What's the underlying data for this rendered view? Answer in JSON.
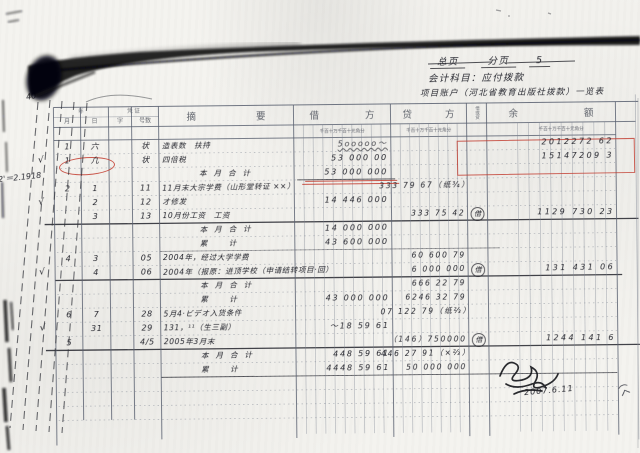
{
  "page_header": {
    "field1": "总页",
    "field2": "分页",
    "page_no": "5"
  },
  "titles": {
    "account_line": "会计科目：应付拨款",
    "project_line": "项目账户（河北省教育出版社拨款）一览表"
  },
  "side_notes": {
    "note1": "2'＝2.1918",
    "note2": "40"
  },
  "form_header": {
    "year": "年",
    "voucher": "凭 证",
    "month": "月",
    "day": "日",
    "zi": "字",
    "hao": "号数",
    "summary": "摘要",
    "debit": "借方",
    "credit": "贷方",
    "direction": "借或贷",
    "balance": "余额",
    "units": "千百十万千百十元角分"
  },
  "check_glyph": "√",
  "check_rows": [
    1,
    4,
    9,
    13
  ],
  "rows": [
    {
      "m": "1",
      "d": "六",
      "h": "状",
      "desc": "造表数　扶持",
      "deb": "5ooooo～",
      "bal": "2012272 62",
      "strike": true
    },
    {
      "m": "1",
      "d": "凢",
      "h": "状",
      "desc": "四倍税",
      "deb": "53 000 00",
      "bal": "15147209 3"
    },
    {
      "desc": "本月合计",
      "deb": "53 000 000",
      "total": true
    },
    {
      "m": "2",
      "d": "1",
      "h": "11",
      "desc": "11月末大宗学费（山形堂转证 ××）",
      "cred": "333 79 67（纸¾）"
    },
    {
      "d": "2",
      "h": "12",
      "desc": "才修发",
      "deb": "14 446 000"
    },
    {
      "d": "3",
      "h": "13",
      "desc": "10月份工资　工资",
      "cred": "333 75 42",
      "dir": "借",
      "bal": "1129 730 23"
    },
    {
      "desc": "本月合计",
      "deb": "14 000 000",
      "total": true
    },
    {
      "desc": "累　计",
      "deb": "43 600 000",
      "total": true
    },
    {
      "m": "4",
      "d": "3",
      "h": "05",
      "desc": "2004年，经过大学学费",
      "cred": "60 600 79"
    },
    {
      "d": "4",
      "h": "06",
      "desc": "2004年（报原：进顶学校（申请结转项目·回）",
      "cred": "6 000 000",
      "dir": "借",
      "bal": "131 431 06"
    },
    {
      "desc": "本月合计",
      "cred": "666 22 79",
      "total": true
    },
    {
      "desc": "累　计",
      "deb": "43 000 000",
      "cred": "6246 32 79",
      "total": true
    },
    {
      "m": "6",
      "d": "7",
      "h": "28",
      "desc": "5月4·ビデオ入货条件",
      "cred": "07 122 79（纸⅔）"
    },
    {
      "d": "31",
      "h": "29",
      "desc": "131，¹¹（生三副）",
      "deb": "～18 59 61"
    },
    {
      "m": "5",
      "h": "4/5",
      "desc": "2005年3月末",
      "cred": "（146）750000",
      "dir": "借",
      "bal": "1244 141 6"
    },
    {
      "desc": "本月合计",
      "deb": "448 59 61",
      "cred": "446 27 91（×⅔）",
      "total": true
    },
    {
      "desc": "累　计",
      "deb": "4448 59 61",
      "cred": "50 000 000",
      "total": true
    },
    {},
    {},
    {}
  ],
  "signature": {
    "date": "2007.6.11"
  },
  "corner_mark": "（ㄑ",
  "colors": {
    "ink": "#23242c",
    "red": "#c23b2e",
    "grid": "#6f7683",
    "paper": "#f4f3ef"
  }
}
